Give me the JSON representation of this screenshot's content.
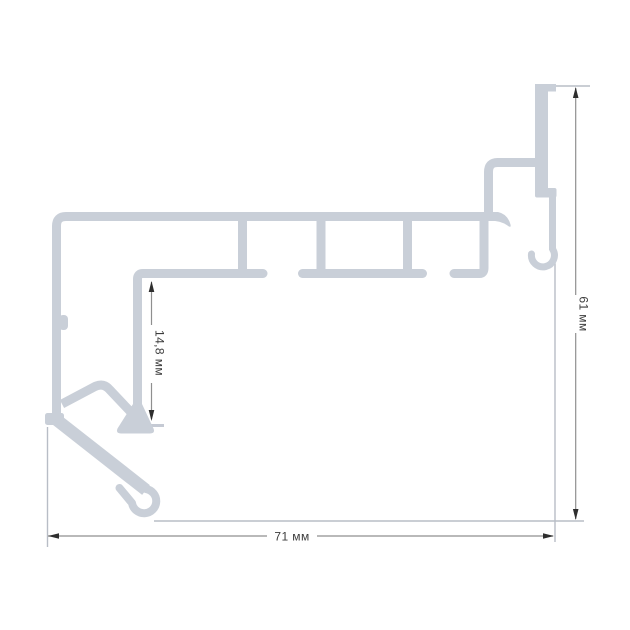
{
  "drawing": {
    "title": "profile-cross-section",
    "unit": "мм",
    "dimensions": {
      "width": {
        "value": "71",
        "label": "71 мм"
      },
      "height": {
        "value": "61",
        "label": "61 мм"
      },
      "flange": {
        "value": "14,8",
        "label": "14,8 мм"
      }
    },
    "colors": {
      "profile": "#c9cfd8",
      "extension_line": "#b8bdc6",
      "dimension_line": "#8f8f8f",
      "arrow": "#2e2e2e",
      "text": "#3c3c3c",
      "background": "#ffffff"
    }
  }
}
